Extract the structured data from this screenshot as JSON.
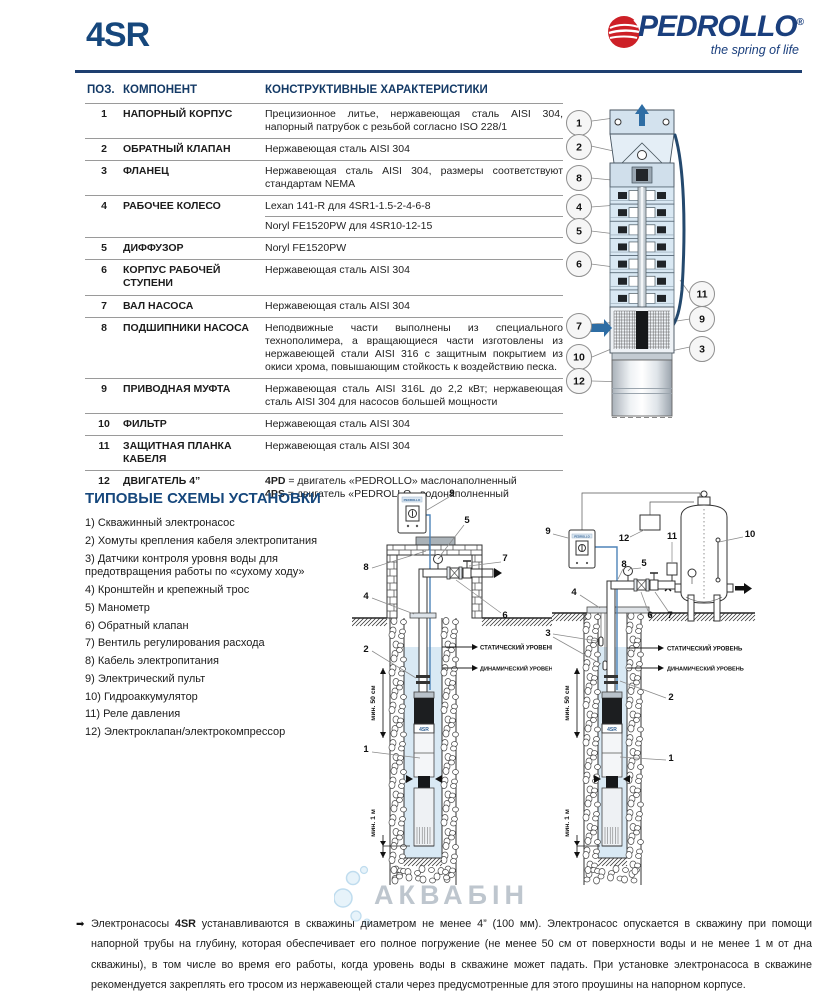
{
  "header": {
    "model": "4SR",
    "brand": "PEDROLLO",
    "reg": "®",
    "tagline": "the spring of life"
  },
  "colors": {
    "brand_blue": "#1a3f7d",
    "brand_red": "#cd2027",
    "heading_blue": "#16477c",
    "diagram_water_blue": "#d9e9f4"
  },
  "table": {
    "headers": {
      "pos": "ПОЗ.",
      "component": "КОМПОНЕНТ",
      "characteristics": "КОНСТРУКТИВНЫЕ ХАРАКТЕРИСТИКИ"
    },
    "rows": [
      {
        "pos": "1",
        "component": "НАПОРНЫЙ КОРПУС",
        "characteristics": [
          {
            "text": "Прецизионное литье, нержавеющая сталь AISI 304, напорный патрубок с резьбой согласно ISO 228/1"
          }
        ]
      },
      {
        "pos": "2",
        "component": "ОБРАТНЫЙ КЛАПАН",
        "characteristics": [
          {
            "text": "Нержавеющая сталь AISI 304"
          }
        ]
      },
      {
        "pos": "3",
        "component": "ФЛАНЕЦ",
        "characteristics": [
          {
            "text": "Нержавеющая сталь AISI 304, размеры соответствуют стандартам NEMA"
          }
        ]
      },
      {
        "pos": "4",
        "component": "РАБОЧЕЕ КОЛЕСО",
        "char_divider": true,
        "characteristics": [
          {
            "text": "Lexan 141-R для 4SR1-1.5-2-4-6-8"
          },
          {
            "text": "Noryl FE1520PW для 4SR10-12-15"
          }
        ]
      },
      {
        "pos": "5",
        "component": "ДИФФУЗОР",
        "characteristics": [
          {
            "text": "Noryl FE1520PW"
          }
        ]
      },
      {
        "pos": "6",
        "component": "КОРПУС РАБОЧЕЙ СТУПЕНИ",
        "characteristics": [
          {
            "text": "Нержавеющая сталь AISI 304"
          }
        ]
      },
      {
        "pos": "7",
        "component": "ВАЛ НАСОСА",
        "characteristics": [
          {
            "text": "Нержавеющая сталь AISI 304"
          }
        ]
      },
      {
        "pos": "8",
        "component": "ПОДШИПНИКИ НАСОСА",
        "characteristics": [
          {
            "text": "Неподвижные части выполнены из специального технополимера, а вращающиеся части изготовлены из нержавеющей стали AISI 316 с защитным покрытием из окиси хрома, повышающим стойкость к воздействию песка."
          }
        ]
      },
      {
        "pos": "9",
        "component": "ПРИВОДНАЯ МУФТА",
        "characteristics": [
          {
            "text": "Нержавеющая сталь AISI 316L до 2,2 кВт; нержавеющая сталь AISI 304 для насосов большей мощности"
          }
        ]
      },
      {
        "pos": "10",
        "component": "ФИЛЬТР",
        "characteristics": [
          {
            "text": "Нержавеющая сталь AISI 304"
          }
        ]
      },
      {
        "pos": "11",
        "component": "ЗАЩИТНАЯ ПЛАНКА КАБЕЛЯ",
        "characteristics": [
          {
            "text": "Нержавеющая сталь AISI 304"
          }
        ]
      },
      {
        "pos": "12",
        "component": "ДВИГАТЕЛЬ 4”",
        "characteristics": [
          {
            "bold": "4PD",
            "text": " = двигатель «PEDROLLO» маслонаполненный"
          },
          {
            "bold": "4PS",
            "text": " = двигатель «PEDROLLO» водонаполненный"
          }
        ]
      }
    ]
  },
  "pump": {
    "c1": "1",
    "c2": "2",
    "c3": "3",
    "c4": "4",
    "c5": "5",
    "c6": "6",
    "c7": "7",
    "c8": "8",
    "c9": "9",
    "c10": "10",
    "c11": "11",
    "c12": "12"
  },
  "schemes": {
    "title": "ТИПОВЫЕ СХЕМЫ УСТАНОВКИ",
    "items": [
      "1) Скважинный электронасос",
      "2) Хомуты крепления кабеля электропитания",
      "3) Датчики контроля уровня воды для предотвращения работы по «сухому ходу»",
      "4) Кронштейн и крепежный трос",
      "5) Манометр",
      "6) Обратный клапан",
      "7) Вентиль регулирования расхода",
      "8) Кабель электропитания",
      "9) Электрический пульт",
      "10) Гидроаккумулятор",
      "11) Реле давления",
      "12) Электроклапан/электрокомпрессор"
    ]
  },
  "install": {
    "labels": {
      "static": "СТАТИЧЕСКИЙ УРОВЕНЬ",
      "dynamic": "ДИНАМИЧЕСКИЙ УРОВЕНЬ",
      "min50": "мин. 50 см",
      "min1": "мин. 1 м",
      "pump": "4SR",
      "panel": "PEDROLLO"
    },
    "left": {
      "c1": "1",
      "c2": "2",
      "c4": "4",
      "c5": "5",
      "c6": "6",
      "c7": "7",
      "c8": "8",
      "c9": "9"
    },
    "right": {
      "c1": "1",
      "c2": "2",
      "c3": "3",
      "c4": "4",
      "c5": "5",
      "c6": "6",
      "c7": "7",
      "c8": "8",
      "c9": "9",
      "c10": "10",
      "c11": "11",
      "c12": "12"
    }
  },
  "watermark": {
    "text": "АКВАБІН"
  },
  "footer": {
    "bullet": "➡",
    "lead": "Электронасосы ",
    "model": "4SR",
    "body": " устанавливаются в скважины диаметром не менее 4” (100 мм). Электронасос опускается в скважину при помощи напорной трубы на глубину, которая обеспечивает его полное погружение (не менее 50 см от поверхности воды и не менее 1 м от дна скважины), в том числе во время его работы, когда уровень воды в скважине может падать. При установке электронасоса в скважине рекомендуется закреплять его тросом из нержавеющей стали через предусмотренные для этого проушины на напорном корпусе."
  }
}
